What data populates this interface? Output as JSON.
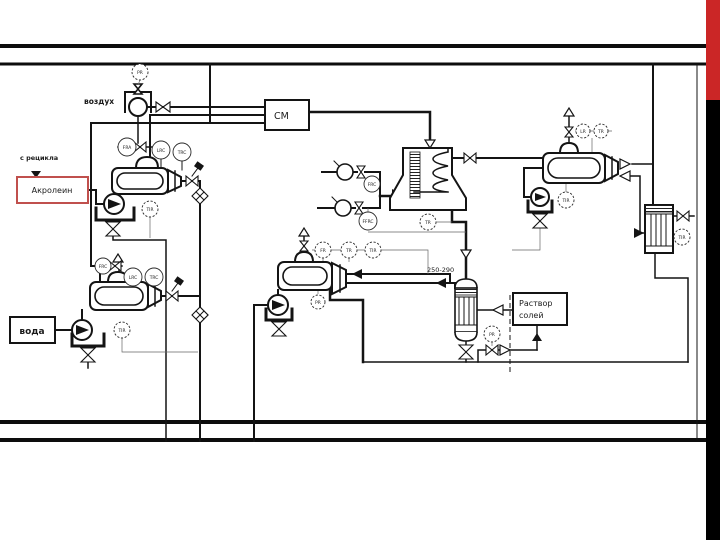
{
  "colors": {
    "accent_red": "#cb2626",
    "accent_black": "#000000",
    "acrolein_border": "#c0504d",
    "line": "#141414"
  },
  "labels": {
    "air": "воздух",
    "recycle": "с рецикла",
    "acrolein": "Акролеин",
    "water": "вода",
    "mixer": "СМ",
    "temp_range": "250-290",
    "salt_line1": "Раствор",
    "salt_line2": "солей"
  },
  "instruments": {
    "air_pr": "PR",
    "evapA_fra": "FRA",
    "evapA_lrc": "LRC",
    "evapA_trc": "TRC",
    "evapA_tir": "TIR",
    "evapB_frc": "FRC",
    "evapB_lrc": "LRC",
    "evapB_trc": "TRC",
    "evapB_tir": "TIR",
    "reactor_frc": "FRC",
    "reactor_ffrc": "FFRC",
    "reactor_tr": "TR",
    "quench_fr": "FR",
    "quench_tr": "TR",
    "quench_tir": "TIR",
    "quench_pr": "PR",
    "sep_lr": "LR",
    "sep_tr": "TR",
    "sep_tir": "TIR",
    "cond_tir": "TIR",
    "salt_pr": "PR"
  }
}
